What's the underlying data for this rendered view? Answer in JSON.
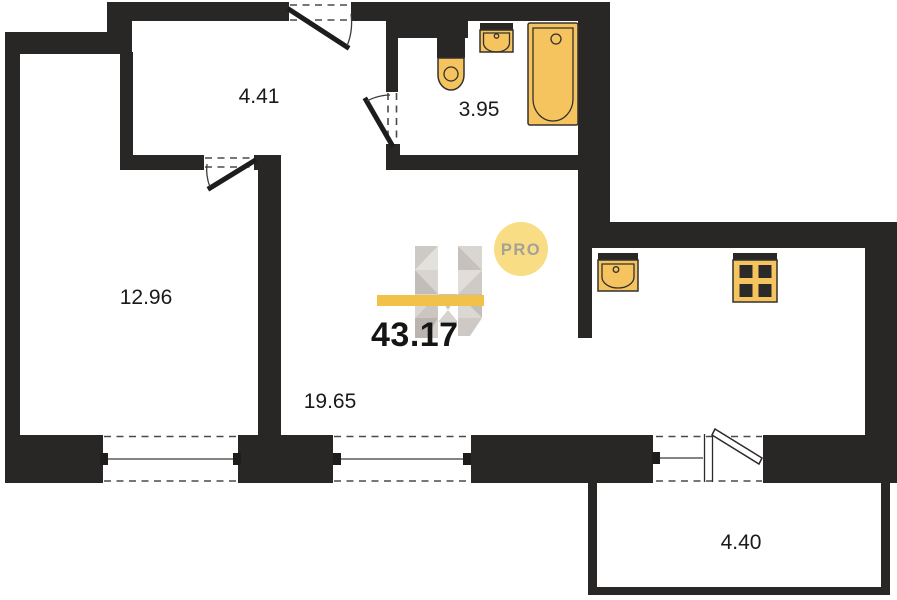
{
  "plan": {
    "total_area": "43.17",
    "logo_badge": "PRO",
    "rooms": [
      {
        "id": "hallway",
        "area": "4.41"
      },
      {
        "id": "bathroom",
        "area": "3.95"
      },
      {
        "id": "bedroom",
        "area": "12.96"
      },
      {
        "id": "living-kitchen",
        "area": "19.65"
      },
      {
        "id": "balcony",
        "area": "4.40"
      }
    ],
    "fixtures": [
      "toilet-icon",
      "wall-sink-icon",
      "bathtub-icon",
      "kitchen-sink-icon",
      "stove-icon"
    ],
    "colors": {
      "wall": "#282725",
      "fixture_fill": "#F6C45F",
      "fixture_stroke": "#33312E",
      "accent_bar": "#F1C14A",
      "badge_fill": "#F8DD85",
      "badge_text": "#A5A098",
      "label": "#1B1A19"
    }
  }
}
